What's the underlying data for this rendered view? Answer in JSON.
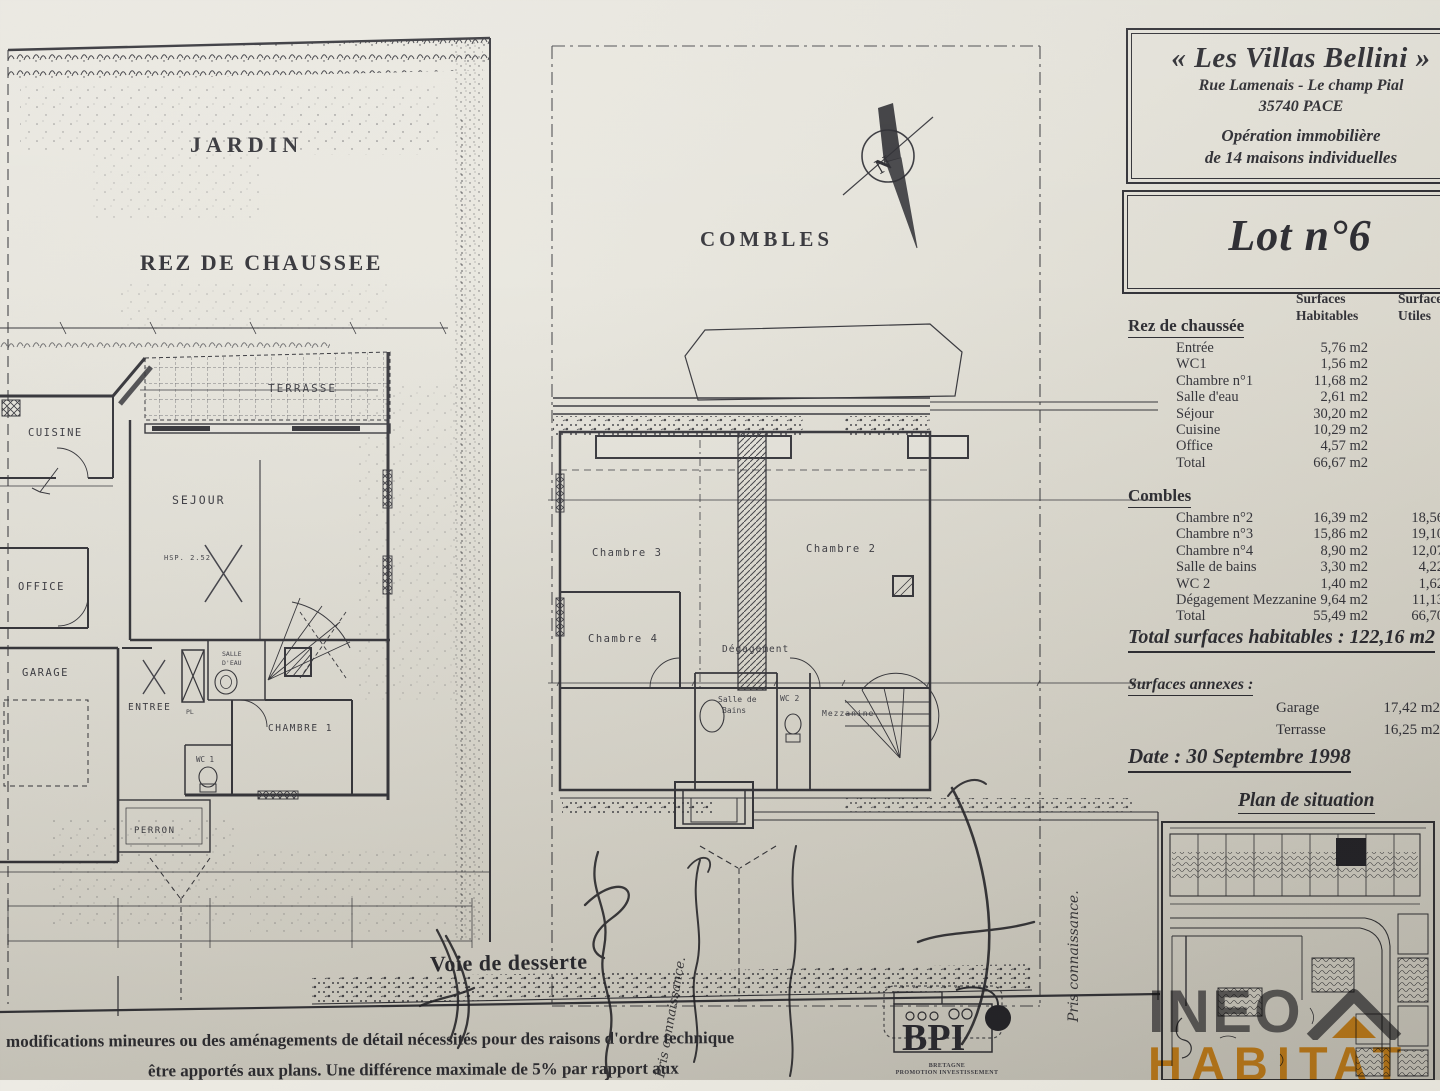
{
  "panel": {
    "title": "« Les Villas Bellini »",
    "address1": "Rue Lamenais - Le champ Pial",
    "address2": "35740 PACE",
    "operation1": "Opération immobilière",
    "operation2": "de 14 maisons individuelles",
    "lot": "Lot n°6",
    "col_hab_1": "Surfaces",
    "col_hab_2": "Habitables",
    "col_util_1": "Surfaces",
    "col_util_2": "Utiles",
    "rdc_title": "Rez de chaussée",
    "rdc_rows": [
      {
        "label": "Entrée",
        "hab": "5,76 m2",
        "utile": ""
      },
      {
        "label": "WC1",
        "hab": "1,56 m2",
        "utile": ""
      },
      {
        "label": "Chambre n°1",
        "hab": "11,68 m2",
        "utile": ""
      },
      {
        "label": "Salle d'eau",
        "hab": "2,61 m2",
        "utile": ""
      },
      {
        "label": "Séjour",
        "hab": "30,20 m2",
        "utile": ""
      },
      {
        "label": "Cuisine",
        "hab": "10,29 m2",
        "utile": ""
      },
      {
        "label": "Office",
        "hab": "4,57 m2",
        "utile": ""
      },
      {
        "label": "Total",
        "hab": "66,67 m2",
        "utile": ""
      }
    ],
    "combles_title": "Combles",
    "combles_rows": [
      {
        "label": "Chambre n°2",
        "hab": "16,39 m2",
        "utile": "18,56"
      },
      {
        "label": "Chambre n°3",
        "hab": "15,86 m2",
        "utile": "19,10"
      },
      {
        "label": "Chambre n°4",
        "hab": "8,90 m2",
        "utile": "12,07"
      },
      {
        "label": "Salle de bains",
        "hab": "3,30 m2",
        "utile": "4,22"
      },
      {
        "label": "WC 2",
        "hab": "1,40 m2",
        "utile": "1,62"
      },
      {
        "label": "Dégagement Mezzanine",
        "hab": "9,64 m2",
        "utile": "11,13"
      },
      {
        "label": "Total",
        "hab": "55,49 m2",
        "utile": "66,70"
      }
    ],
    "total_line": "Total surfaces habitables : 122,16 m2",
    "annexes_title": "Surfaces annexes :",
    "annexe_garage_label": "Garage",
    "annexe_garage_value": "17,42 m2",
    "annexe_terrasse_label": "Terrasse",
    "annexe_terrasse_value": "16,25 m2",
    "date_line": "Date : 30 Septembre 1998",
    "situation_title": "Plan de situation"
  },
  "plans": {
    "jardin": "JARDIN",
    "rdc_title": "REZ DE CHAUSSEE",
    "combles_title": "COMBLES",
    "north": "N",
    "road": "Voie de desserte",
    "rooms_rdc": {
      "terrasse": "TERRASSE",
      "cuisine": "CUISINE",
      "sejour": "SEJOUR",
      "hsp": "HSP. 2.52",
      "office": "OFFICE",
      "garage": "GARAGE",
      "entree": "ENTREE",
      "pl": "PL",
      "salle_eau_1": "SALLE",
      "salle_eau_2": "D'EAU",
      "chambre1": "CHAMBRE 1",
      "wc1": "WC 1",
      "perron": "PERRON"
    },
    "rooms_combles": {
      "chambre2": "Chambre 2",
      "chambre3": "Chambre 3",
      "chambre4": "Chambre 4",
      "degagement": "Dégagement",
      "salle_bains_1": "Salle de",
      "salle_bains_2": "Bains",
      "wc2": "WC 2",
      "mezzanine": "Mezzanine"
    },
    "handwritten": "Pris connaissance."
  },
  "footer": {
    "note1": "modifications mineures ou des aménagements de détail nécessités pour des raisons d'ordre technique",
    "note2": "être apportés aux plans. Une différence maximale de 5% par rapport aux"
  },
  "bpi": {
    "name": "BPI",
    "sub1": "BRETAGNE",
    "sub2": "PROMOTION INVESTISSEMENT"
  },
  "watermark": {
    "line1": "INEO",
    "line2": "HABITAT"
  },
  "colors": {
    "ink": "#2a2a30",
    "paper": "#e2dfd6",
    "orange": "#ee920a",
    "gray": "#48484e"
  }
}
